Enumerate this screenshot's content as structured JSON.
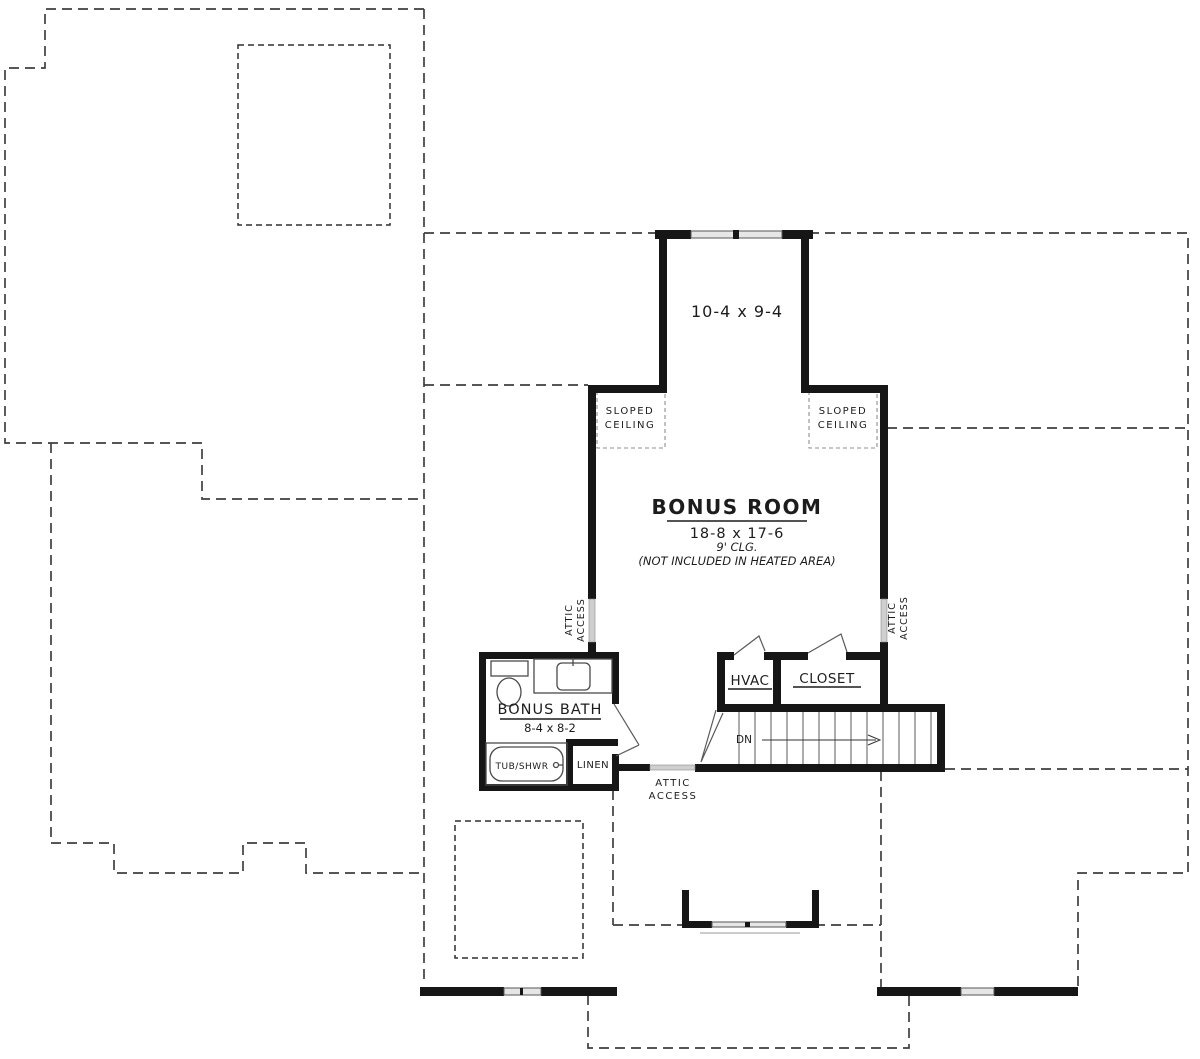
{
  "labels": {
    "upper_dim": "10-4 x 9-4",
    "sloped": [
      "SLOPED",
      "CEILING"
    ],
    "bonus_room": {
      "name": "BONUS ROOM",
      "dim": "18-8 x 17-6",
      "ceiling": "9' CLG.",
      "note": "(NOT INCLUDED IN HEATED AREA)"
    },
    "attic": [
      "ATTIC",
      "ACCESS"
    ],
    "hvac": "HVAC",
    "closet": "CLOSET",
    "bath": {
      "name": "BONUS BATH",
      "dim": "8-4 x 8-2"
    },
    "tub": "TUB/SHWR",
    "linen": "LINEN",
    "dn": "DN"
  },
  "colors": {
    "wall": "#161616",
    "dashed_outline": "#3f3f3f",
    "access_panel": "#cfcfcf",
    "window_glass": "#e6e6e6",
    "background": "#ffffff"
  }
}
